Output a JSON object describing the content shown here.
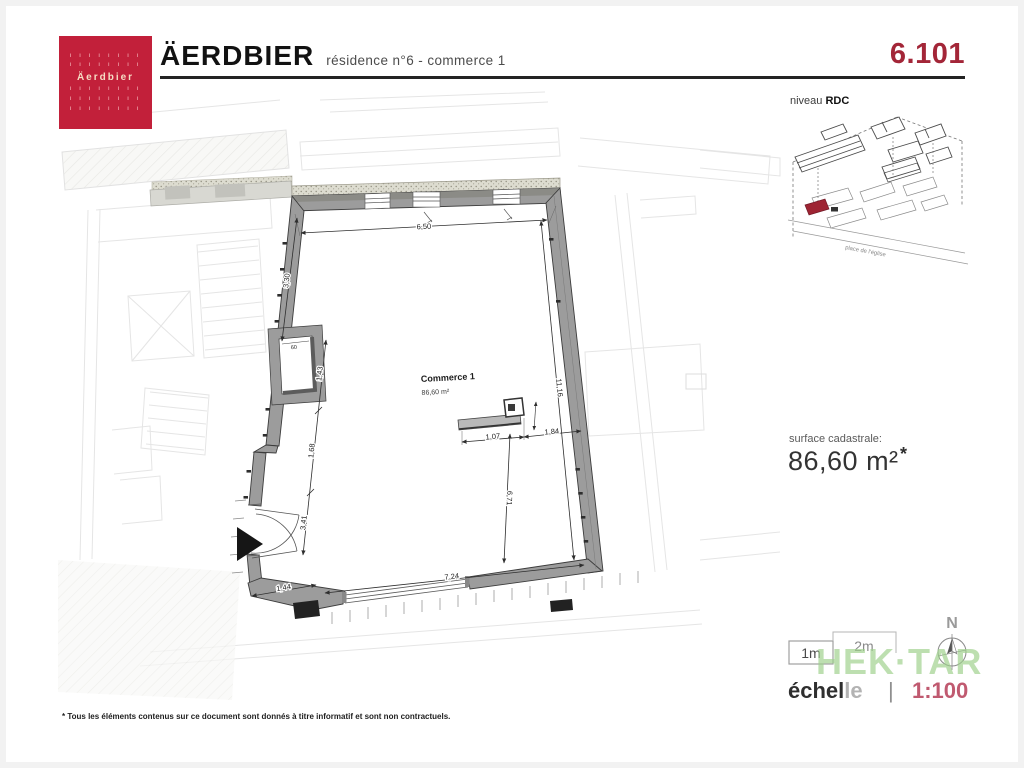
{
  "header": {
    "title": "ÄERDBIER",
    "subtitle": "résidence n°6 - commerce 1",
    "plan_number": "6.101",
    "logo": {
      "name": "Äerdbier",
      "dot_row": "ı ı ı ı ı ı ı ı"
    }
  },
  "locator": {
    "level_label": "niveau",
    "level_value": "RDC",
    "street_label": "place de l'église"
  },
  "surface": {
    "label": "surface cadastrale:",
    "value": "86,60 m²",
    "star": "*"
  },
  "scalebar": {
    "m1": "1m",
    "m2": "2m"
  },
  "north": {
    "label": "N"
  },
  "watermark": "HEK·TAR",
  "scale_line": {
    "word_dark": "échel",
    "word_light": "le",
    "separator": "|",
    "value": "1:100"
  },
  "plan": {
    "room_label": "Commerce 1",
    "room_area": "86,60 m²",
    "dims": {
      "top": "6,50",
      "left_upper": "3,30",
      "left_mid": "1,43",
      "left_lower": "1,68",
      "left_door": "3,41",
      "entry_width": "1,44",
      "bottom": "7,24",
      "right_side": "11,16",
      "center_vert": "6,71",
      "counter_left": "1,07",
      "counter_right": "1,84",
      "niche": "60"
    }
  },
  "footer": {
    "disclaimer": "* Tous les éléments contenus sur ce document sont donnés à titre informatif et sont non contractuels."
  },
  "colors": {
    "brand_red": "#c2203a",
    "plan_number_red": "#a32638",
    "scale_value_rose": "#c05a70",
    "watermark_green": "#9ed18c",
    "wall_gray": "#9c9c9c"
  }
}
